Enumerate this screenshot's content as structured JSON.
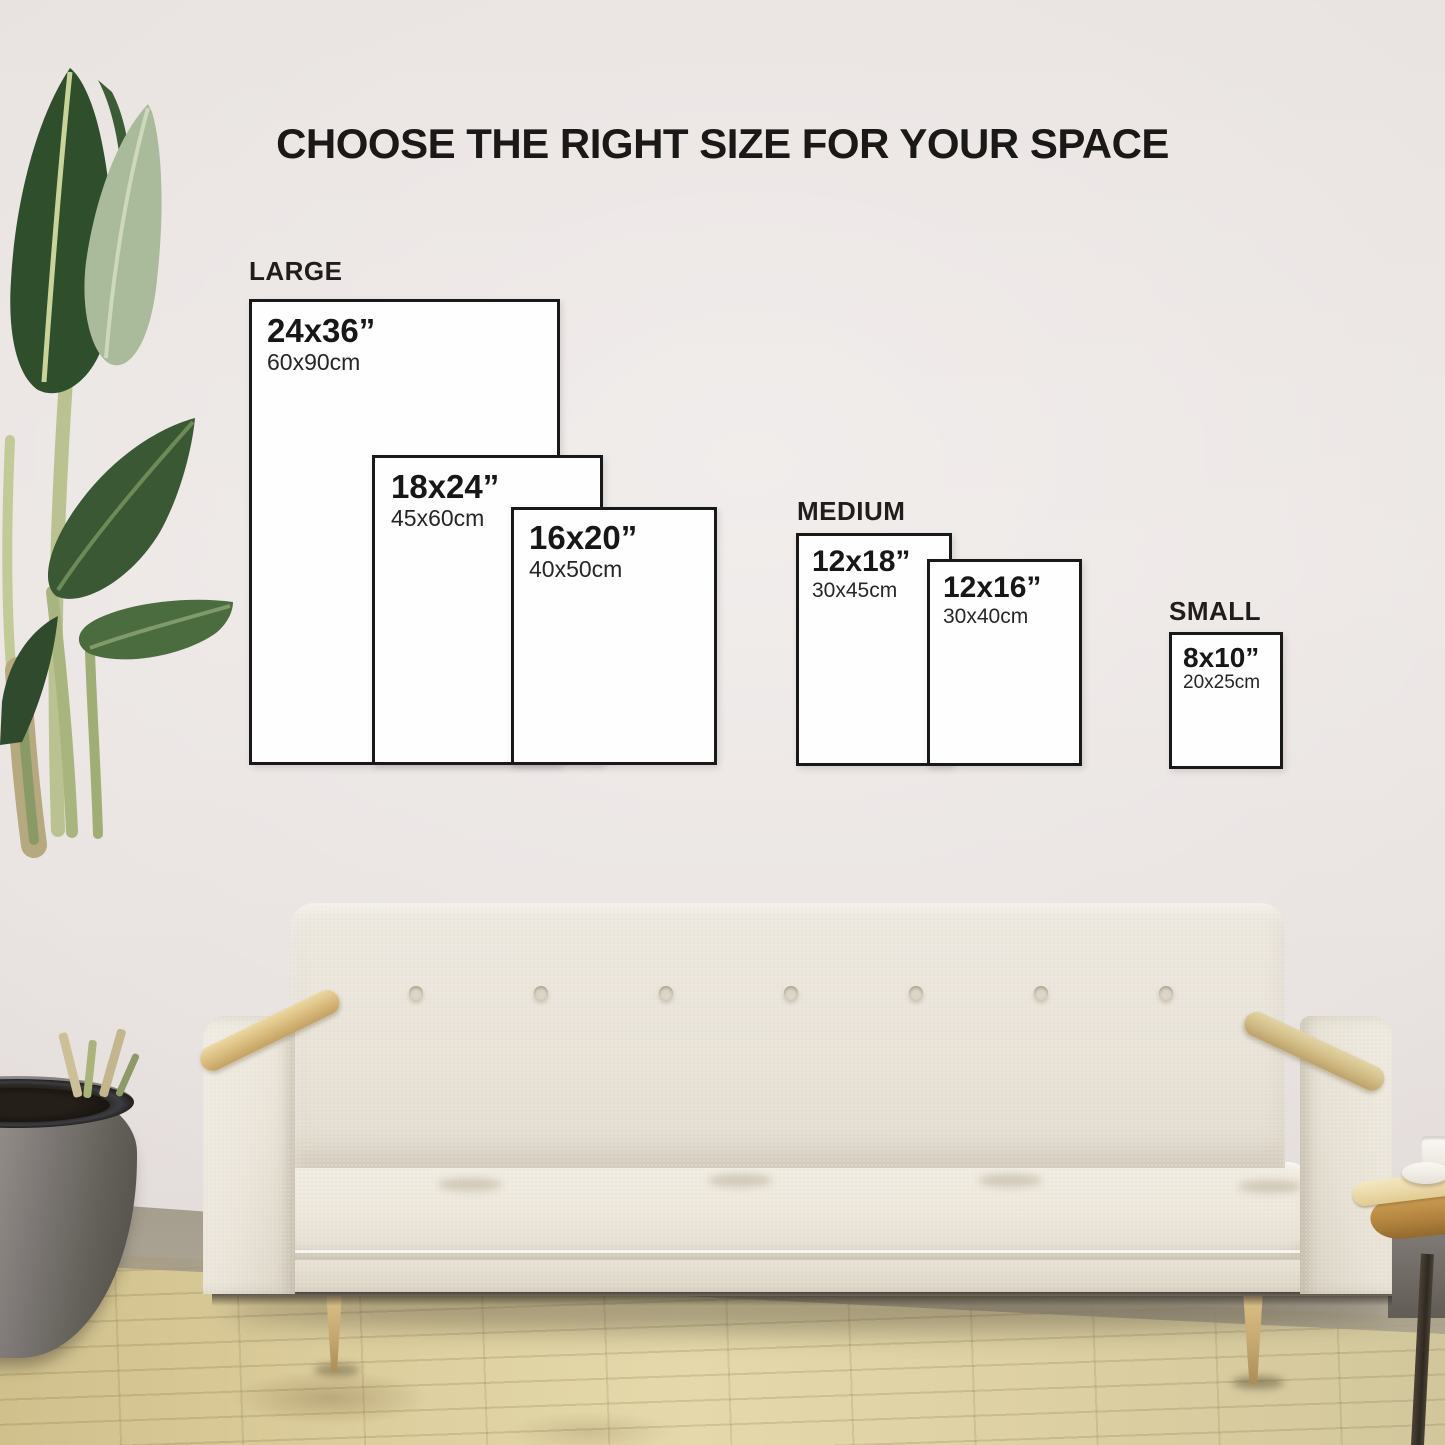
{
  "title": "CHOOSE THE RIGHT SIZE FOR YOUR SPACE",
  "size_groups": [
    {
      "label": "LARGE",
      "sizes": [
        {
          "inches": "24x36”",
          "cm": "60x90cm"
        },
        {
          "inches": "18x24”",
          "cm": "45x60cm"
        },
        {
          "inches": "16x20”",
          "cm": "40x50cm"
        }
      ]
    },
    {
      "label": "MEDIUM",
      "sizes": [
        {
          "inches": "12x18”",
          "cm": "30x45cm"
        },
        {
          "inches": "12x16”",
          "cm": "30x40cm"
        }
      ]
    },
    {
      "label": "SMALL",
      "sizes": [
        {
          "inches": "8x10”",
          "cm": "20x25cm"
        }
      ]
    }
  ],
  "scene": {
    "description": "size guide boxes on a living-room wall above a cream tufted sofa, bird-of-paradise plant in gray pot at left, wooden side table with white dishes at right, light wood floor",
    "palette": {
      "wall": "#ebe5e3",
      "floor_wood": "#ddd0a0",
      "box_border": "#191919",
      "box_fill": "#fefefe",
      "text": "#1b1918",
      "sofa_fabric": "#e9e3d8",
      "sofa_wood": "#d3b376",
      "plant_green_dark": "#31502c",
      "plant_green_light": "#a9bb9b",
      "pot_gray": "#7b7673",
      "table_wood": "#c2964d"
    }
  }
}
